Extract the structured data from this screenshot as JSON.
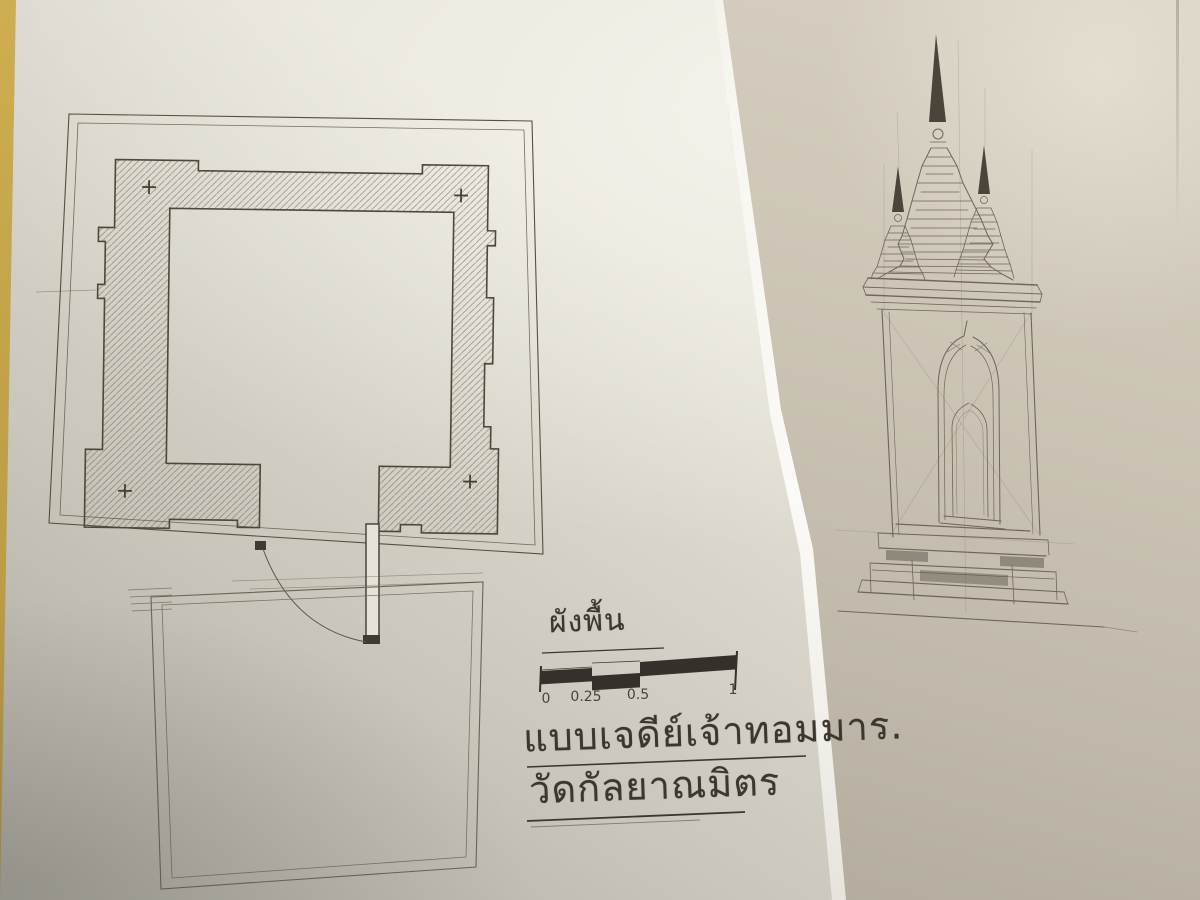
{
  "colors": {
    "table_surface": "#c3a348",
    "front_sheet_paper": "#e7e3d8",
    "rear_sheet_paper": "#ccc5b6",
    "ink_line": "#4a4436",
    "pencil_line": "#6e6759",
    "scale_bar_fill": "#35312a"
  },
  "plan_figure": {
    "title": "ผังพื้น",
    "corner_mark": "+",
    "corner_mark_count": 4
  },
  "scale_bar": {
    "labels": [
      "0",
      "0.25",
      "0.5",
      "1"
    ]
  },
  "captions": {
    "line1": "แบบเจดีย์เจ้าทอมมาร.",
    "line2": "วัดกัลยาณมิตร"
  }
}
